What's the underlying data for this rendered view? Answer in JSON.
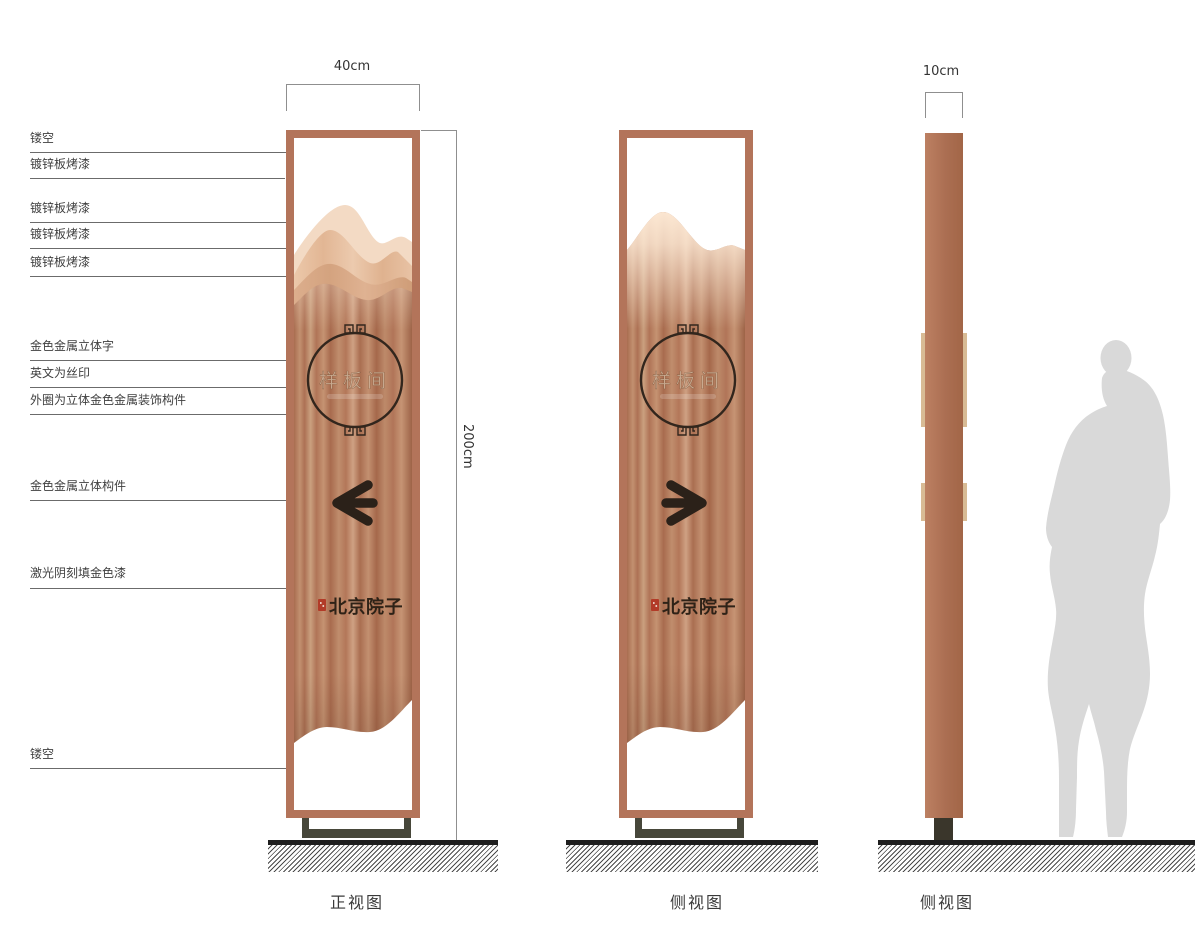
{
  "dimensions": {
    "front_width": "40cm",
    "profile_width": "10cm",
    "height": "200cm"
  },
  "annotations": [
    "镂空",
    "镀锌板烤漆",
    "镀锌板烤漆",
    "镀锌板烤漆",
    "镀锌板烤漆",
    "金色金属立体字",
    "英文为丝印",
    "外圈为立体金色金属装饰构件",
    "金色金属立体构件",
    "激光阴刻填金色漆",
    "镂空"
  ],
  "sign": {
    "circle_text": "样板间",
    "brand_text": "北京院子",
    "front_arrow_direction": "left",
    "side_arrow_direction": "right"
  },
  "captions": {
    "front": "正视图",
    "side": "侧视图",
    "profile": "侧视图"
  },
  "colors": {
    "frame_copper": "#b3745a",
    "copper_light": "#cfa183",
    "copper_dark": "#9d6347",
    "mountain_light": "#f3dac4",
    "tab_tan": "#d8bb95",
    "seal_red": "#b23b28",
    "base_dark": "#47473a",
    "silhouette_gray": "#d9d9d9"
  }
}
